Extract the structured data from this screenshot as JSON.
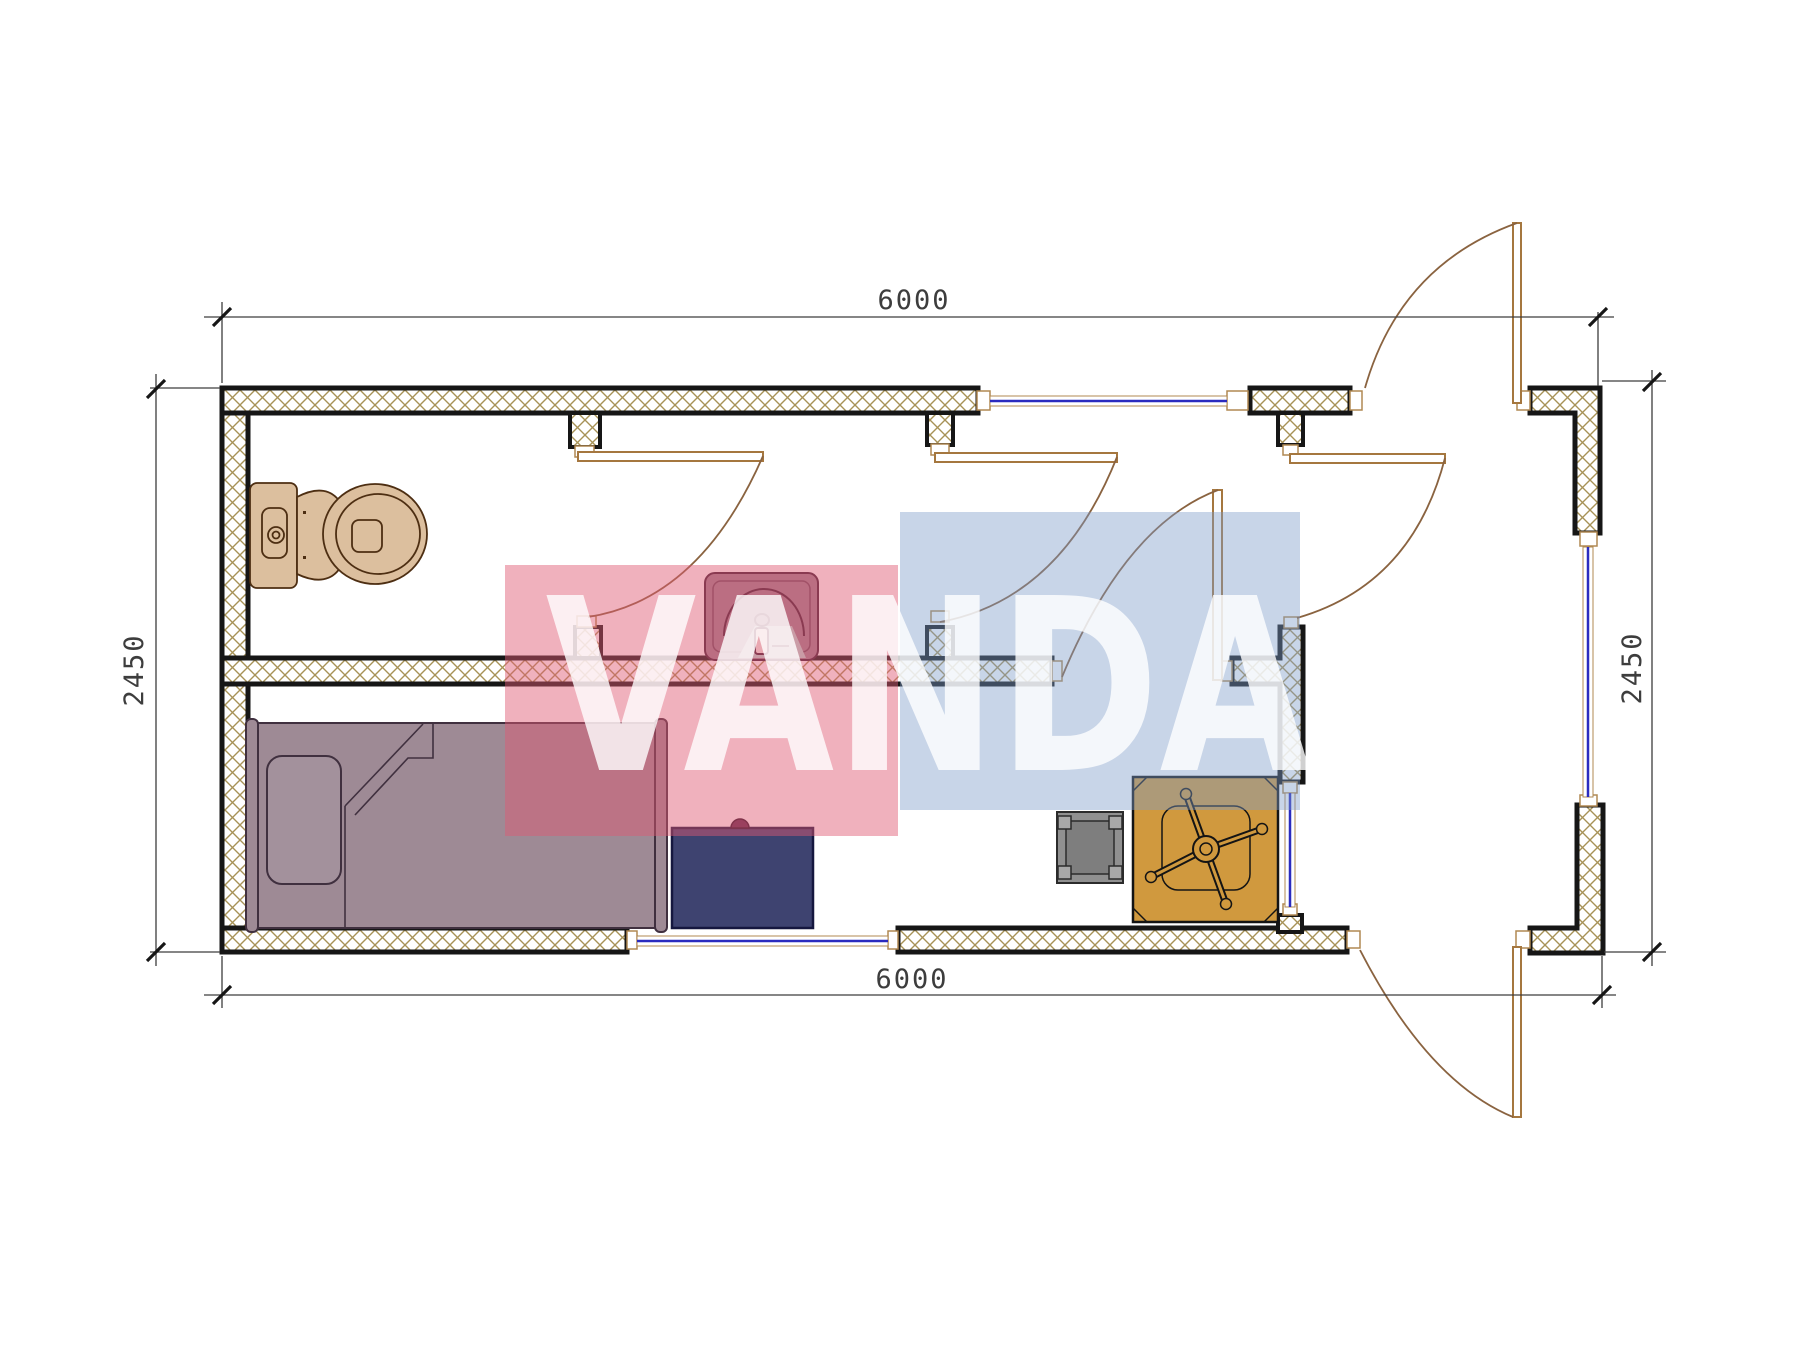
{
  "drawing": {
    "type": "architectural floor plan",
    "unit_width_label": "6000",
    "unit_height_label": "2450"
  },
  "dimensions": {
    "top": "6000",
    "bottom": "6000",
    "left": "2450",
    "right": "2450"
  },
  "watermark": {
    "text": "VANDA",
    "pink_color": "#e05a73",
    "blue_color": "#7d9bc8",
    "text_color": "#ffffff"
  },
  "colors": {
    "wall_outline": "#161616",
    "wall_hatch": "#a79257",
    "window_glass": "#2b2bbf",
    "door_leaf": "#a5773f",
    "door_arc": "#8a6340",
    "dimension_line": "#3d3d3d",
    "toilet_fill": "#dcbf9e",
    "toilet_outline": "#4d2e12",
    "sink_fill": "#9c8190",
    "sink_outline": "#3f1f33",
    "sink_soap_fill": "#b8d8d4",
    "bed_fill": "#9e8a95",
    "bed_outline": "#40303f",
    "desk_fill": "#3e4370",
    "desk_outline": "#15173f",
    "stool_fill": "#909090",
    "stool_inner": "#7e7e7e",
    "stool_outline": "#2b2b2b",
    "table_fill": "#d0993e",
    "table_outline": "#141414"
  },
  "furniture": [
    {
      "name": "toilet"
    },
    {
      "name": "sink"
    },
    {
      "name": "single-bed"
    },
    {
      "name": "desk"
    },
    {
      "name": "stool"
    },
    {
      "name": "dining-table"
    }
  ]
}
